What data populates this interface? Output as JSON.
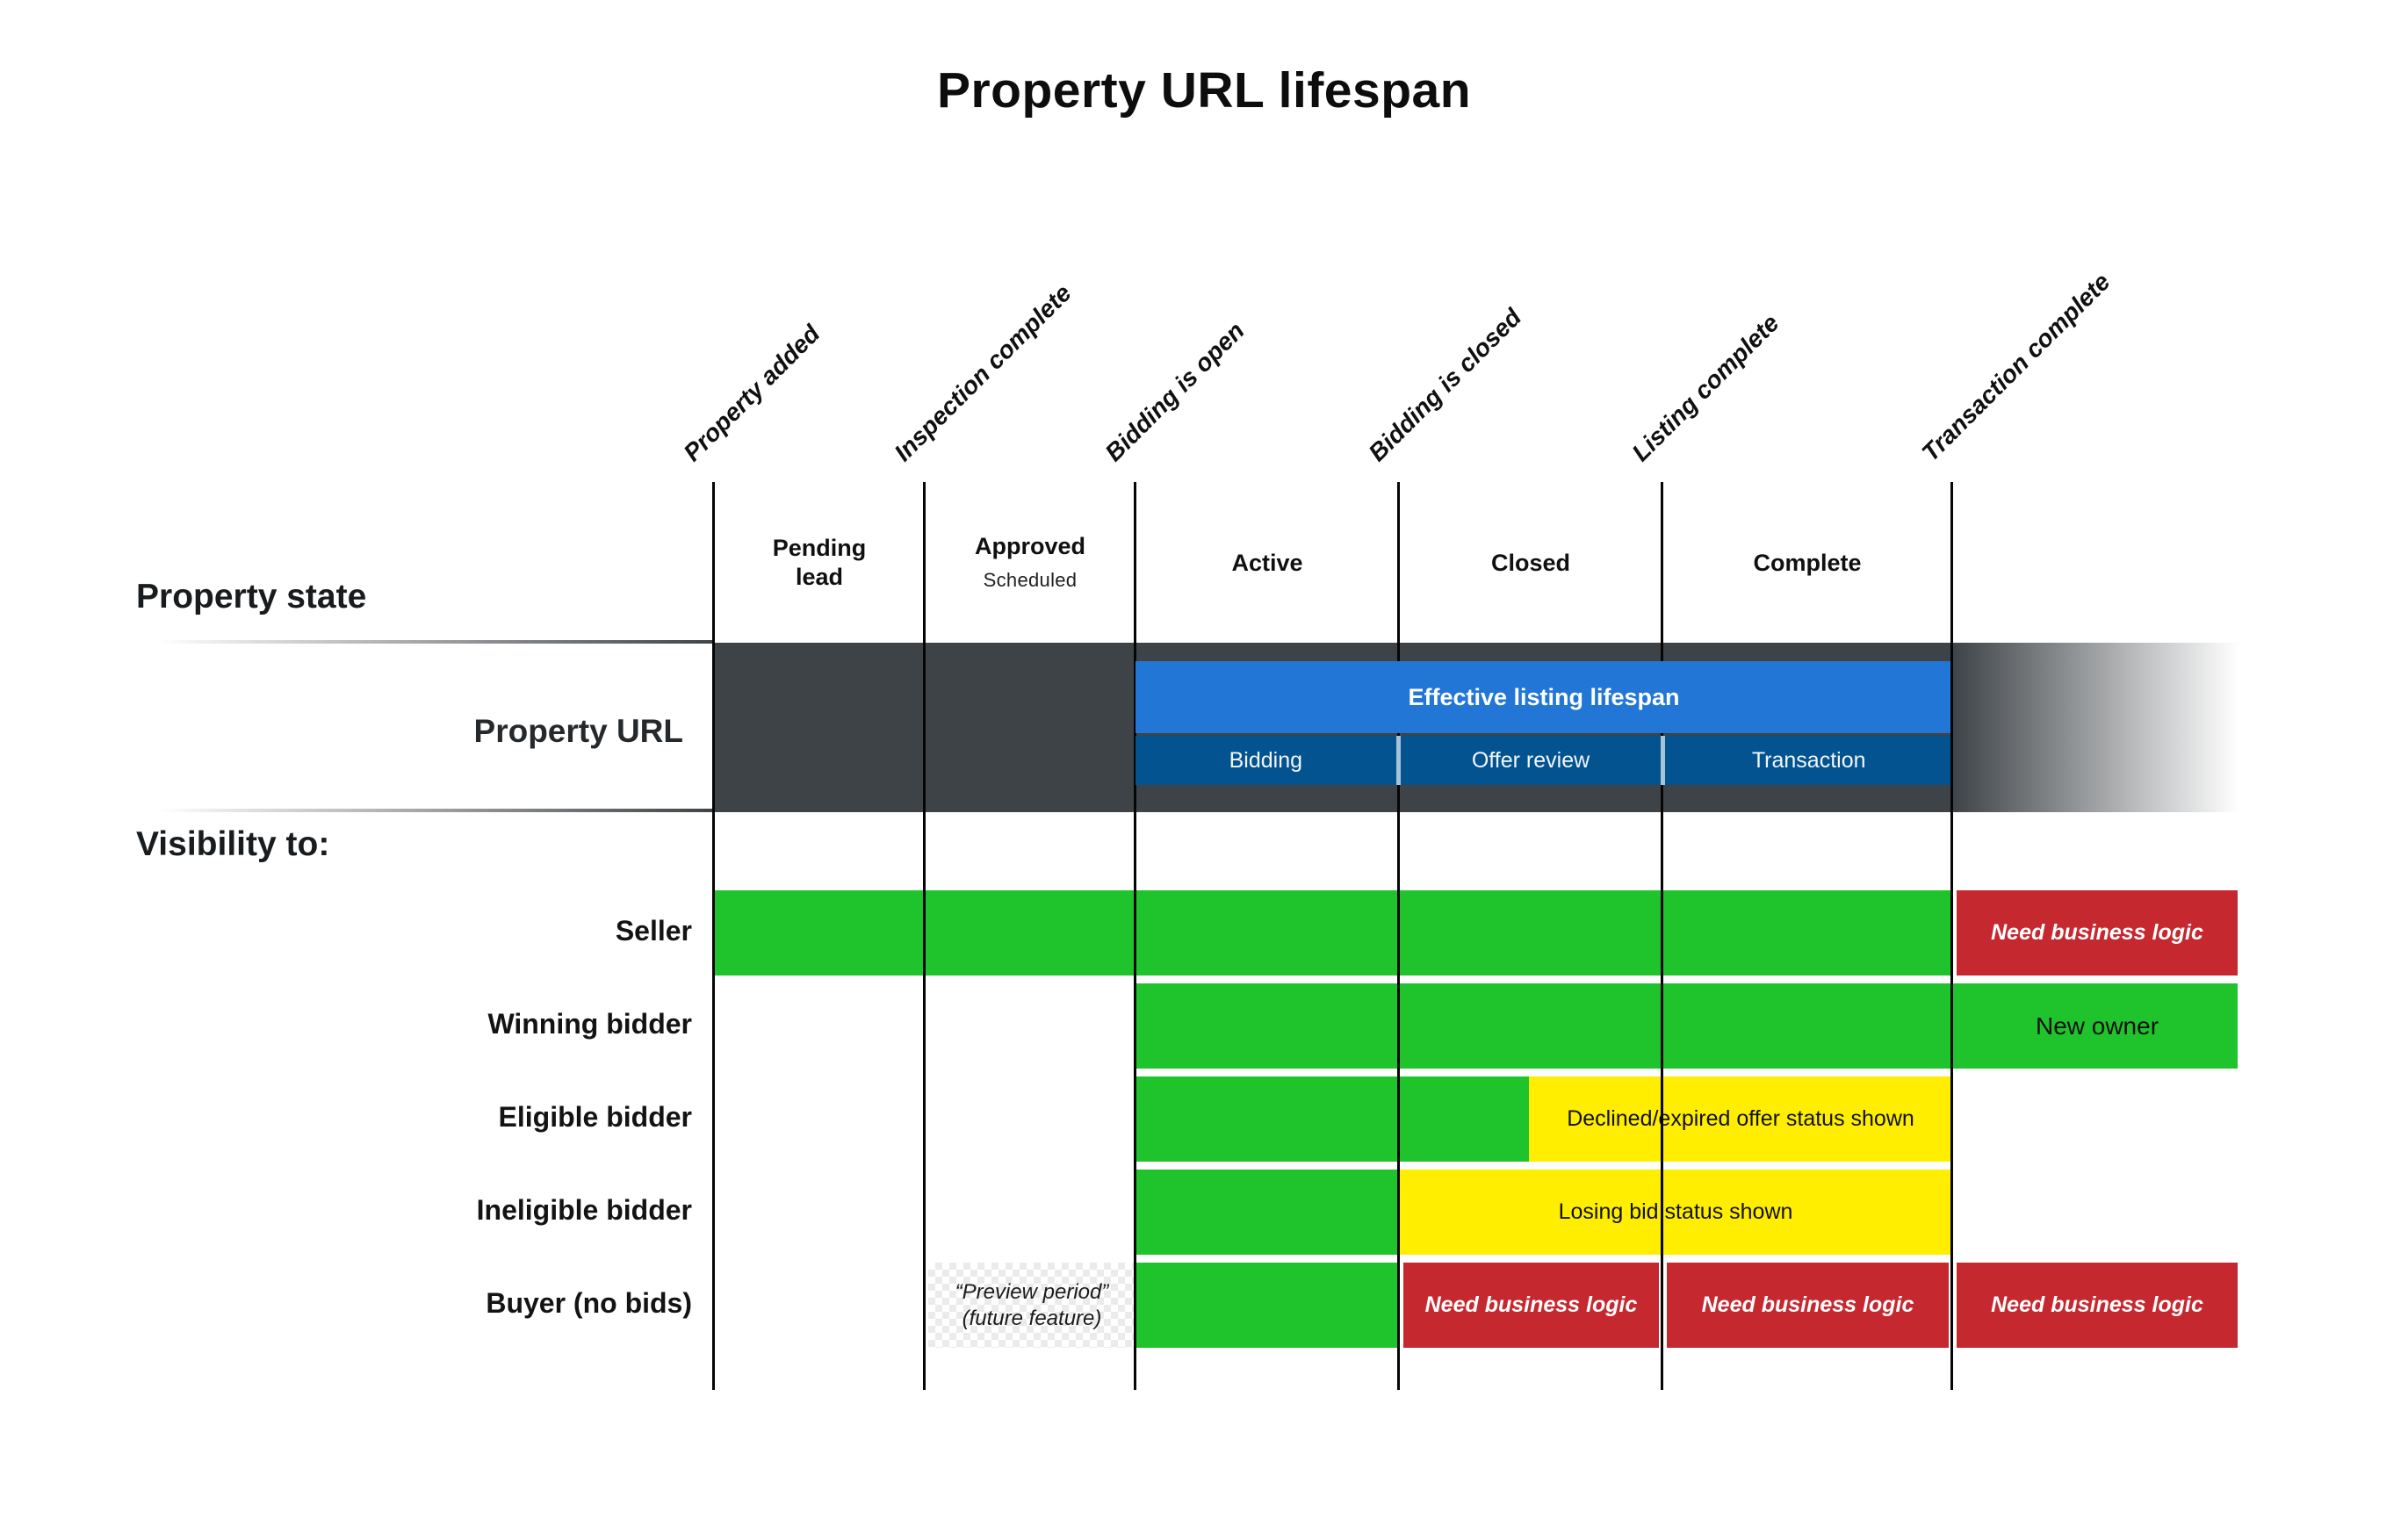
{
  "title": "Property URL lifespan",
  "colors": {
    "green": "#1fc42d",
    "yellow": "#ffee00",
    "red": "#c5282f",
    "blue": "#2176d6",
    "dark_blue": "#035390",
    "dark_band": "#3e4347"
  },
  "milestones": {
    "labels": [
      "Property added",
      "Inspection complete",
      "Bidding is open",
      "Bidding is closed",
      "Listing complete",
      "Transaction complete"
    ]
  },
  "property_state": {
    "row_label": "Property state",
    "states": [
      {
        "name": "Pending lead"
      },
      {
        "name": "Approved",
        "sub": "Scheduled"
      },
      {
        "name": "Active"
      },
      {
        "name": "Closed"
      },
      {
        "name": "Complete"
      }
    ]
  },
  "property_url": {
    "row_label": "Property URL",
    "lifespan_label": "Effective listing lifespan",
    "phases": [
      "Bidding",
      "Offer review",
      "Transaction"
    ]
  },
  "visibility": {
    "section_label": "Visibility to:",
    "rows": [
      {
        "label": "Seller",
        "right_note": "Need business logic"
      },
      {
        "label": "Winning bidder",
        "right_note": "New owner"
      },
      {
        "label": "Eligible bidder",
        "bar_note": "Declined/expired offer status shown"
      },
      {
        "label": "Ineligible bidder",
        "bar_note": "Losing bid status shown"
      },
      {
        "label": "Buyer (no bids)",
        "preview_line1": "“Preview period”",
        "preview_line2": "(future feature)",
        "notes": [
          "Need business logic",
          "Need business logic",
          "Need business logic"
        ]
      }
    ]
  }
}
